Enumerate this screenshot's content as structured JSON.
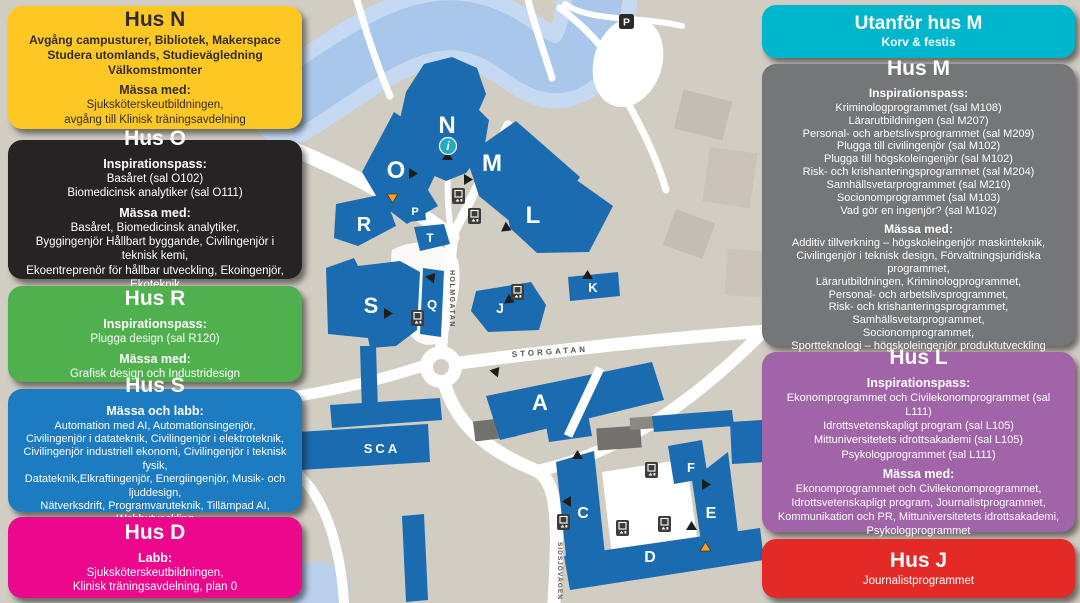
{
  "colors": {
    "hus_n": "#fdc823",
    "hus_o": "#272324",
    "hus_r": "#4fb04e",
    "hus_s": "#1d7bc2",
    "hus_d": "#ec088c",
    "utanfor_hus_m": "#00b6cd",
    "hus_m": "#757678",
    "hus_l": "#a164a8",
    "hus_j": "#e32a26",
    "campus_building": "#1b6bb0",
    "water": "#a9c7ea",
    "land": "#d2cdc3"
  },
  "info_boxes": {
    "hus_n": {
      "title": "Hus N",
      "lines": [
        "Avgång campusturer, Bibliotek, Makerspace",
        "Studera utomlands, Studievägledning",
        "Välkomstmonter",
        "Mässa med:",
        "Sjuksköterskeutbildningen,",
        "avgång till Klinisk träningsavdelning"
      ]
    },
    "hus_o": {
      "title": "Hus O",
      "lines": [
        "Inspirationspass:",
        "Basåret (sal O102)",
        "Biomedicinsk analytiker (sal O111)",
        "Mässa med:",
        "Basåret, Biomedicinsk analytiker,",
        "Byggingenjör Hållbart byggande, Civilingenjör i teknisk kemi,",
        "Ekoentreprenör för hållbar utveckling, Ekoingenjör, Ekoteknik"
      ]
    },
    "hus_r": {
      "title": "Hus R",
      "lines": [
        "Inspirationspass:",
        "Plugga design (sal R120)",
        "Mässa med:",
        "Grafisk design och Industridesign"
      ]
    },
    "hus_s": {
      "title": "Hus S",
      "lines": [
        "Mässa och labb:",
        "Automation med AI, Automationsingenjör,",
        "Civilingenjör i datateknik, Civilingenjör i elektroteknik,",
        "Civilingenjör industriell ekonomi, Civilingenjör i teknisk fysik,",
        "Datateknik,Elkraftingenjör, Energiingenjör, Musik- och ljuddesign,",
        "Nätverksdrift, Programvaruteknik, Tillämpad AI, Webbutveckling"
      ]
    },
    "hus_d": {
      "title": "Hus D",
      "lines": [
        "Labb:",
        "Sjuksköterskeutbildningen,",
        "Klinisk träningsavdelning, plan 0"
      ]
    },
    "utanfor_hus_m": {
      "title": "Utanför hus M",
      "lines": [
        "Korv & festis"
      ]
    },
    "hus_m": {
      "title": "Hus M",
      "lines": [
        "Inspirationspass:",
        "Kriminologprogrammet (sal M108)",
        "Lärarutbildningen (sal M207)",
        "Personal- och arbetslivsprogrammet (sal M209)",
        "Plugga till civilingenjör (sal M102)",
        "Plugga till högskoleingenjör (sal M102)",
        "Risk- och krishanteringsprogrammet (sal M204)",
        "Samhällsvetarprogrammet (sal M210)",
        "Socionomprogrammet (sal M103)",
        "Vad gör en ingenjör? (sal M102)",
        "Mässa med:",
        "Additiv tillverkning – högskoleingenjör maskinteknik,",
        "Civilingenjör i teknisk design, Förvaltningsjuridiska programmet,",
        "Lärarutbildningen, Kriminologprogrammet,",
        "Personal- och arbetslivsprogrammet,",
        "Risk- och krishanteringsprogrammet, Samhällsvetarprogrammet,",
        "Socionomprogrammet,",
        "Sportteknologi – högskoleingenjör produktutveckling"
      ]
    },
    "hus_l": {
      "title": "Hus L",
      "lines": [
        "Inspirationspass:",
        "Ekonomprogrammet och Civilekonomprogrammet (sal L111)",
        "Idrottsvetenskapligt program (sal L105)",
        "Mittuniversitetets idrottsakademi (sal L105)",
        "Psykologprogrammet (sal L111)",
        "Mässa med:",
        "Ekonomprogrammet och Civilekonomprogrammet,",
        "Idrottsvetenskapligt program, Journalistprogrammet,",
        "Kommunikation och PR, Mittuniversitetets idrottsakademi,",
        "Psykologprogrammet"
      ]
    },
    "hus_j": {
      "title": "Hus J",
      "lines": [
        "Journalistprogrammet"
      ]
    }
  },
  "map": {
    "building_labels": {
      "n": "N",
      "o": "O",
      "r": "R",
      "p": "P",
      "t": "T",
      "s": "S",
      "q": "Q",
      "m": "M",
      "l": "L",
      "j": "J",
      "k": "K",
      "a": "A",
      "sca": "SCA",
      "c": "C",
      "d": "D",
      "e": "E",
      "f": "F"
    },
    "street_labels": {
      "storgatan": "STORGATAN",
      "holmgatan": "HOLMGATAN",
      "sidsjovagen": "SIDSJÖVÄGEN"
    },
    "icons": {
      "info": "i",
      "parking": "P"
    }
  }
}
